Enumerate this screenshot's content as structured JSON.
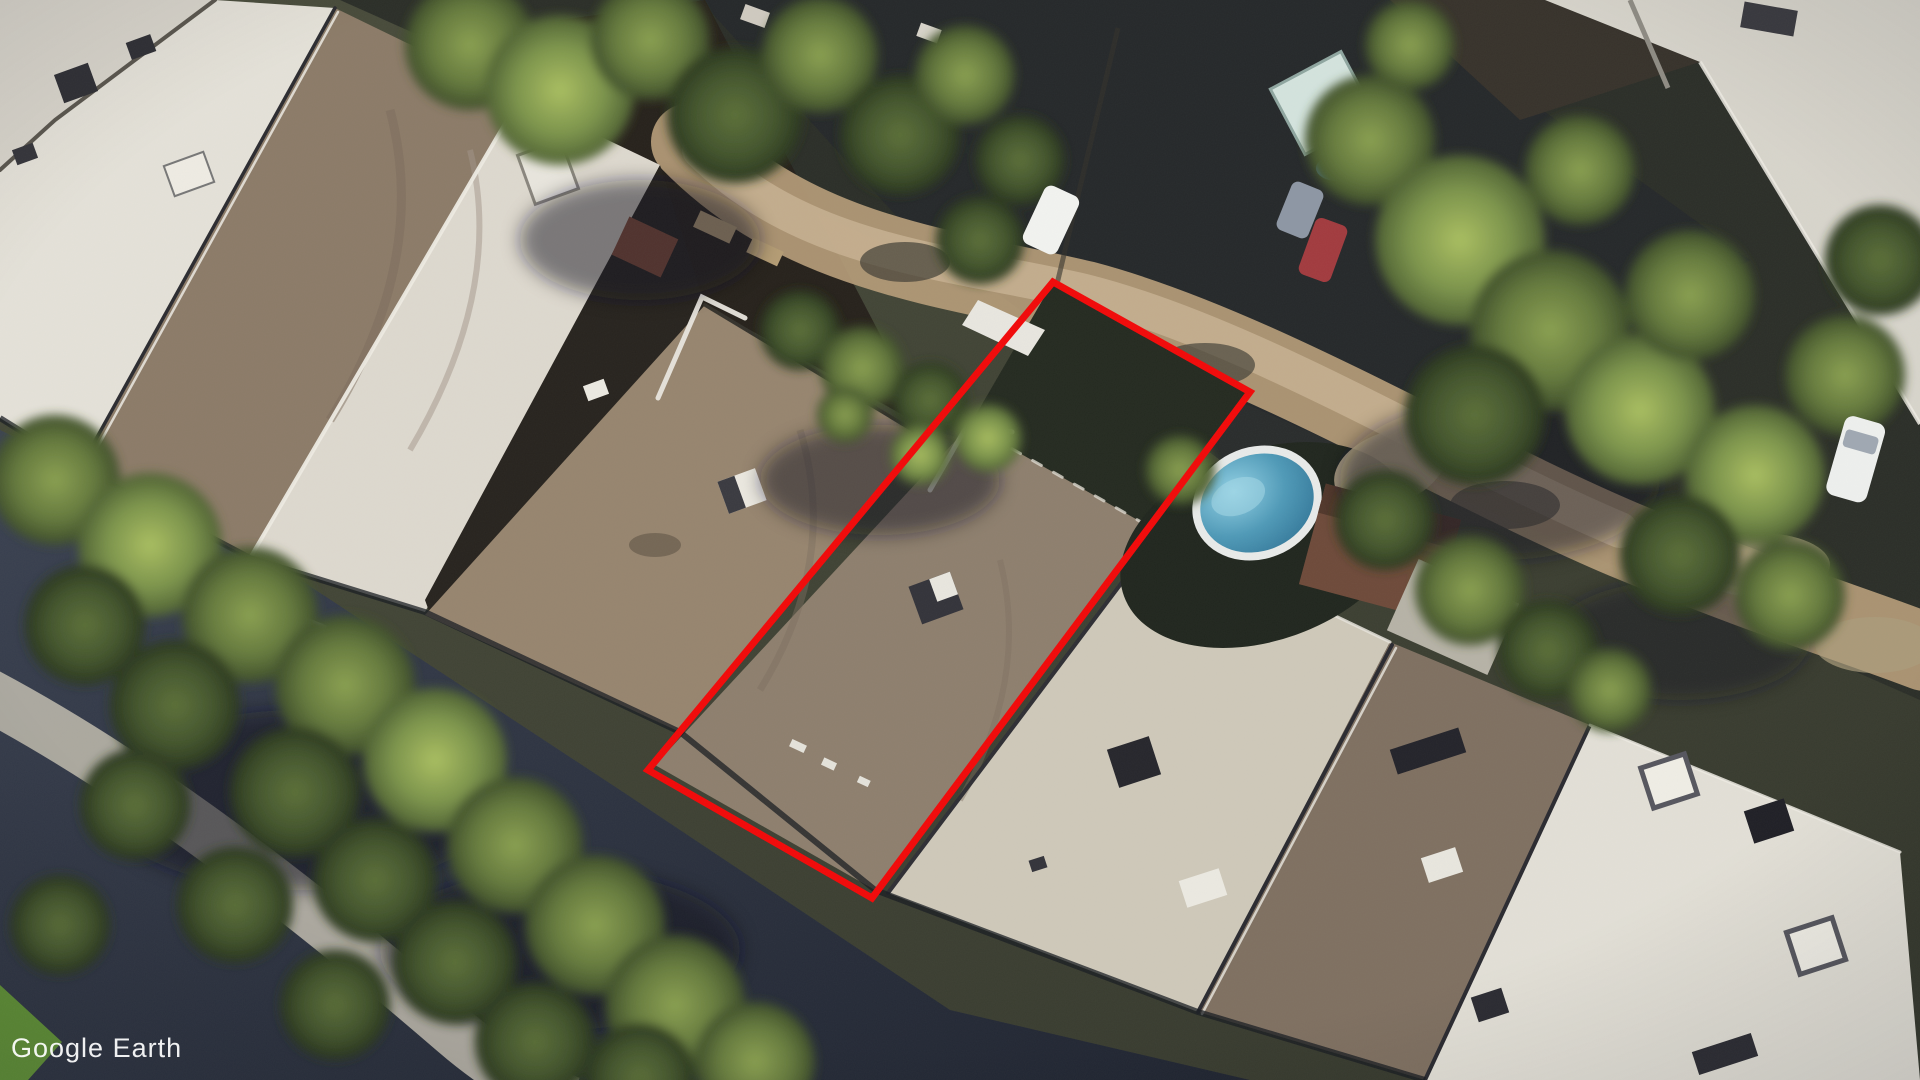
{
  "app": {
    "watermark": "Google Earth"
  },
  "annotation": {
    "label": "property-boundary-outline",
    "shape": "quadrilateral",
    "points": "1053,282 1250,392 872,898 648,770",
    "stroke_color": "#f20808",
    "stroke_width": "7"
  },
  "scene": {
    "type": "oblique-aerial-satellite-imagery",
    "features": [
      "flat-roof rowhouses",
      "tree canopy",
      "backyard swimming pool",
      "dirt alley",
      "parked cars",
      "sidewalk",
      "garden sheds"
    ]
  },
  "colors": {
    "roof_white": "#e5e2d9",
    "roof_brown": "#8c7b68",
    "roof_light_gray": "#cfc9ba",
    "tree_green": "#7a924a",
    "pool_water": "#4f9ab8",
    "street_shadow": "#2a3040",
    "alley_dirt": "#b59c78"
  }
}
